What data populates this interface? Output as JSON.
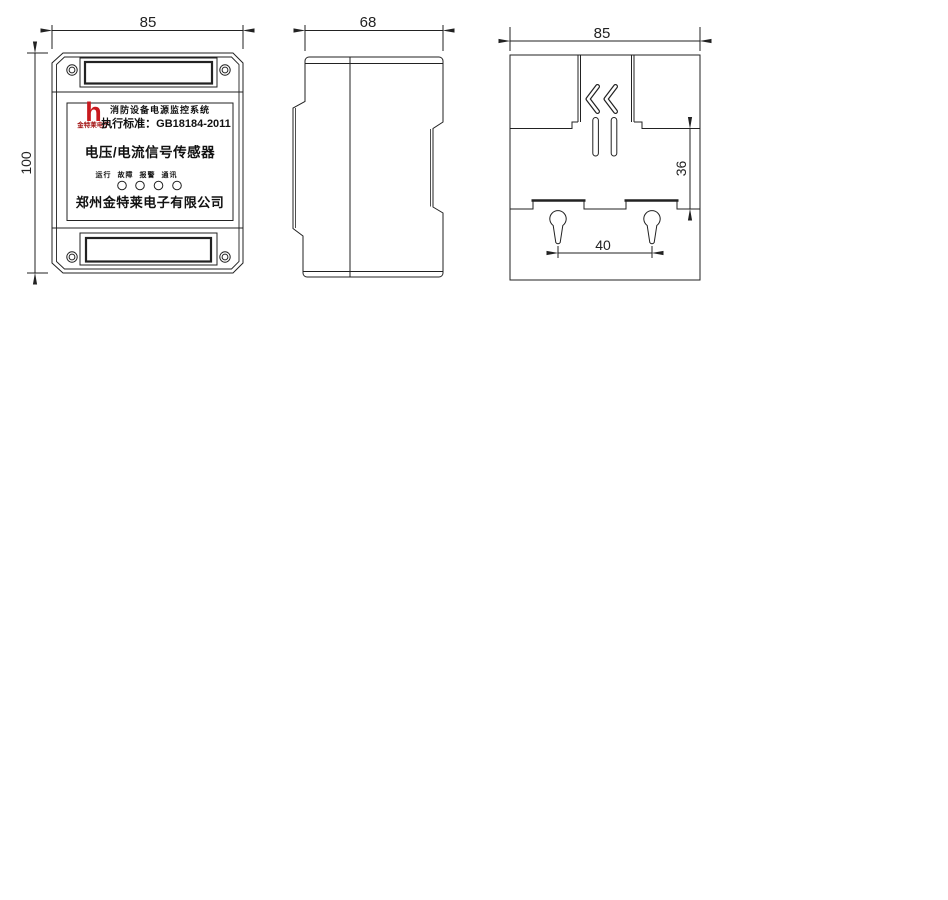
{
  "front_view": {
    "dim_width_label": "85",
    "dim_height_label": "100",
    "nameplate": {
      "logo_glyph": "h",
      "logo_caption": "金特莱电子",
      "logo_color": "#c8191e",
      "system_line": "消防设备电源监控系统",
      "standard_line": "执行标准：GB18184-2011",
      "product_name": "电压/电流信号传感器",
      "indicators": [
        "运行",
        "故障",
        "报警",
        "通讯"
      ],
      "company_name": "郑州金特莱电子有限公司"
    }
  },
  "side_view": {
    "dim_width_label": "68"
  },
  "back_view": {
    "dim_width_label": "85",
    "dim_rail_height_label": "36",
    "dim_hole_spacing_label": "40"
  }
}
